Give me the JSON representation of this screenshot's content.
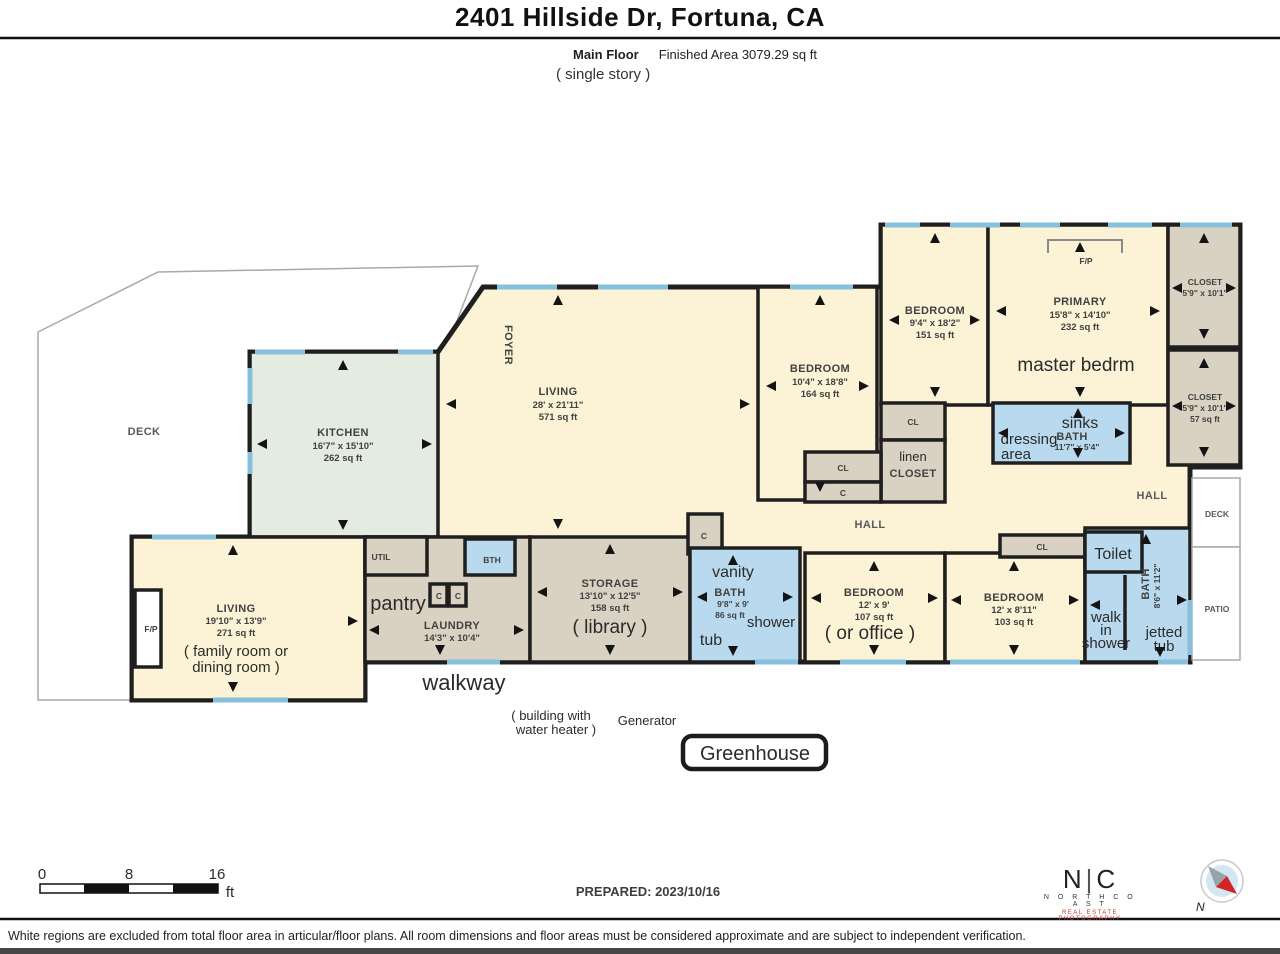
{
  "header": {
    "address": "2401 Hillside Dr, Fortuna, CA",
    "floor_label": "Main Floor",
    "area_label": "Finished Area 3079.29 sq ft",
    "story_note": "( single story )"
  },
  "plan": {
    "deck_left": "DECK",
    "foyer": "FOYER",
    "kitchen": {
      "name": "KITCHEN",
      "dims": "16'7\" x 15'10\"",
      "area": "262 sq ft"
    },
    "living": {
      "name": "LIVING",
      "dims": "28' x 21'11\"",
      "area": "571 sq ft"
    },
    "bedroom_164": {
      "name": "BEDROOM",
      "dims": "10'4\" x 18'8\"",
      "area": "164 sq ft"
    },
    "bedroom_151": {
      "name": "BEDROOM",
      "dims": "9'4\" x 18'2\"",
      "area": "151 sq ft"
    },
    "primary": {
      "name": "PRIMARY",
      "dims": "15'8\" x 14'10\"",
      "area": "232 sq ft",
      "note": "master bedrm",
      "fp": "F/P"
    },
    "closet_tr": {
      "name": "CLOSET",
      "dims": "5'9\" x 10'1\""
    },
    "closet_r2": {
      "name": "CLOSET",
      "dims": "5'9\" x 10'1\"",
      "area": "57 sq ft"
    },
    "primary_bath": {
      "sinks": "sinks",
      "name": "BATH",
      "dims": "11'7\" x 5'4\"",
      "note1": "dressing",
      "note2": "area"
    },
    "cl_a": "CL",
    "linen1": "linen",
    "linen2": "CLOSET",
    "cl_b": "CL",
    "c_a": "C",
    "hall_center": "HALL",
    "hall_right": "HALL",
    "deck_right": "DECK",
    "patio": "PATIO",
    "family": {
      "name": "LIVING",
      "dims": "19'10\" x 13'9\"",
      "area": "271 sq ft",
      "note1": "( family room or",
      "note2": "dining room )",
      "fp": "F/P"
    },
    "util": "UTIL",
    "bth": "BTH",
    "pantry": "pantry",
    "c1": "C",
    "c2": "C",
    "laundry": {
      "name": "LAUNDRY",
      "dims": "14'3\" x 10'4\""
    },
    "storage": {
      "name": "STORAGE",
      "dims": "13'10\" x 12'5\"",
      "area": "158 sq ft",
      "note": "( library )"
    },
    "c_small": "C",
    "bath86": {
      "vanity": "vanity",
      "name": "BATH",
      "dims": "9'8\" x 9'",
      "area": "86 sq ft",
      "shower": "shower",
      "tub": "tub"
    },
    "bedroom_107": {
      "name": "BEDROOM",
      "dims": "12' x 9'",
      "area": "107 sq ft",
      "note": "( or office )"
    },
    "bedroom_103": {
      "name": "BEDROOM",
      "dims": "12' x 8'11\"",
      "area": "103 sq ft"
    },
    "cl_c": "CL",
    "toilet": "Toilet",
    "bath_right": {
      "name": "BATH",
      "dims": "8'6\" x 11'2\"",
      "w1": "walk",
      "w2": "in",
      "w3": "shower",
      "j1": "jetted",
      "j2": "tub"
    },
    "annotations": {
      "walkway": "walkway",
      "building1": "( building with",
      "building2": "water heater )",
      "generator": "Generator",
      "greenhouse": "Greenhouse"
    }
  },
  "footer": {
    "scale": {
      "t0": "0",
      "t8": "8",
      "t16": "16",
      "unit": "ft"
    },
    "prepared": "PREPARED: 2023/10/16",
    "logo": {
      "n": "N",
      "bar": "|",
      "c": "C",
      "line1": "N O R T H   C O A S T",
      "line2": "REAL ESTATE PHOTOGRAPHY"
    },
    "compass_n": "N",
    "disclaimer": "White regions are excluded from total floor area in articular/floor plans. All room dimensions and floor areas must be considered approximate and are subject to independent verification."
  },
  "colors": {
    "wall": "#1f1f1f",
    "window": "#87c0dc",
    "room_cream": "#fcf3d6",
    "kitchen_green": "#e4ece1",
    "closet_tan": "#d9d2c3",
    "bath_blue": "#b9daee"
  }
}
